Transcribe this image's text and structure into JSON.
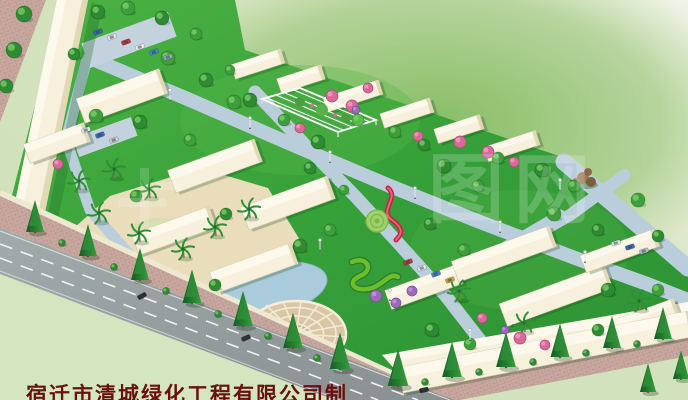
{
  "credit": {
    "text": "宿迁市清城绿化工程有限公司制"
  },
  "watermark": {
    "text": "图网"
  },
  "colors": {
    "background_top": "#f0f3e6",
    "background_field": "#86bd66",
    "lawn": "#38a03a",
    "road_main": "#97a0a0",
    "road_path": "#b9cddb",
    "sidewalk": "#c7a7a0",
    "building": "#f6f0dc",
    "plaza": "#d9c6a4",
    "water": "#aacbdb",
    "conifer": "#1d6e2c",
    "credit_red": "#6a1010",
    "watermark_white": "#ffffff"
  },
  "scene": {
    "buildings": [
      [
        258,
        64,
        52,
        15,
        -18
      ],
      [
        301,
        79,
        46,
        15,
        -18
      ],
      [
        353,
        96,
        58,
        15,
        -18
      ],
      [
        407,
        113,
        52,
        15,
        -18
      ],
      [
        459,
        129,
        48,
        15,
        -18
      ],
      [
        512,
        146,
        54,
        15,
        -18
      ],
      [
        122,
        96,
        88,
        26,
        -20
      ],
      [
        57,
        143,
        64,
        20,
        -20
      ],
      [
        215,
        166,
        92,
        24,
        -20
      ],
      [
        288,
        203,
        92,
        24,
        -20
      ],
      [
        174,
        231,
        82,
        22,
        -20
      ],
      [
        254,
        268,
        86,
        22,
        -20
      ],
      [
        424,
        287,
        76,
        20,
        -20
      ],
      [
        504,
        254,
        104,
        22,
        -20
      ],
      [
        556,
        296,
        112,
        24,
        -20
      ],
      [
        620,
        251,
        78,
        18,
        -20
      ],
      [
        646,
        317,
        64,
        16,
        -20
      ],
      [
        546,
        352,
        296,
        26,
        -11
      ]
    ],
    "conifers": [
      [
        35,
        232,
        1
      ],
      [
        88,
        256,
        1
      ],
      [
        140,
        280,
        1
      ],
      [
        192,
        303,
        1.05
      ],
      [
        243,
        326,
        1.1
      ],
      [
        293,
        348,
        1.1
      ],
      [
        340,
        369,
        1.15
      ],
      [
        398,
        386,
        1.15
      ],
      [
        452,
        377,
        1.1
      ],
      [
        506,
        367,
        1.1
      ],
      [
        560,
        357,
        1.05
      ],
      [
        612,
        348,
        1
      ],
      [
        663,
        339,
        1
      ],
      [
        648,
        392,
        0.9
      ],
      [
        681,
        379,
        0.9
      ]
    ],
    "roundTrees": [
      [
        24,
        14,
        8,
        1
      ],
      [
        14,
        50,
        8,
        1
      ],
      [
        6,
        86,
        7,
        1
      ],
      [
        98,
        12,
        7,
        1
      ],
      [
        128,
        8,
        7,
        0
      ],
      [
        162,
        18,
        7,
        1
      ],
      [
        196,
        34,
        6,
        0
      ],
      [
        74,
        54,
        6,
        1
      ],
      [
        168,
        58,
        7,
        0
      ],
      [
        206,
        80,
        7,
        1
      ],
      [
        96,
        116,
        7,
        0
      ],
      [
        140,
        122,
        7,
        1
      ],
      [
        234,
        102,
        7,
        0
      ],
      [
        250,
        100,
        7,
        1
      ],
      [
        284,
        120,
        6,
        0
      ],
      [
        318,
        142,
        7,
        1
      ],
      [
        230,
        70,
        5,
        0
      ],
      [
        358,
        120,
        6,
        2
      ],
      [
        395,
        132,
        6,
        0
      ],
      [
        424,
        145,
        6,
        1
      ],
      [
        498,
        158,
        6,
        0
      ],
      [
        542,
        170,
        7,
        1
      ],
      [
        574,
        186,
        6,
        0
      ],
      [
        190,
        140,
        6,
        0
      ],
      [
        310,
        168,
        6,
        1
      ],
      [
        344,
        190,
        5,
        0
      ],
      [
        300,
        246,
        7,
        1
      ],
      [
        330,
        230,
        6,
        0
      ],
      [
        226,
        214,
        6,
        1
      ],
      [
        136,
        196,
        6,
        0
      ],
      [
        215,
        285,
        6,
        1
      ],
      [
        444,
        166,
        7,
        1
      ],
      [
        478,
        186,
        6,
        0
      ],
      [
        430,
        224,
        6,
        1
      ],
      [
        554,
        214,
        7,
        0
      ],
      [
        598,
        230,
        6,
        1
      ],
      [
        638,
        200,
        7,
        0
      ],
      [
        658,
        236,
        6,
        1
      ],
      [
        464,
        250,
        6,
        0
      ],
      [
        608,
        290,
        7,
        1
      ],
      [
        658,
        290,
        6,
        0
      ],
      [
        432,
        330,
        7,
        1
      ],
      [
        470,
        344,
        6,
        0
      ],
      [
        598,
        330,
        6,
        1
      ],
      [
        62,
        243,
        3.5,
        1
      ],
      [
        114,
        267,
        3.5,
        1
      ],
      [
        166,
        291,
        3.5,
        1
      ],
      [
        218,
        314,
        3.5,
        1
      ],
      [
        268,
        336,
        3.5,
        1
      ],
      [
        317,
        358,
        3.5,
        1
      ],
      [
        425,
        382,
        3.5,
        1
      ],
      [
        479,
        372,
        3.5,
        1
      ],
      [
        533,
        362,
        3.5,
        1
      ],
      [
        586,
        353,
        3.5,
        1
      ],
      [
        637,
        344,
        3.5,
        1
      ]
    ],
    "palms": [
      [
        80,
        190
      ],
      [
        115,
        178
      ],
      [
        150,
        198
      ],
      [
        100,
        222
      ],
      [
        140,
        242
      ],
      [
        184,
        258
      ],
      [
        216,
        236
      ],
      [
        250,
        218
      ],
      [
        460,
        300
      ],
      [
        525,
        332
      ],
      [
        640,
        310
      ]
    ],
    "pinkShrubs": [
      [
        332,
        96,
        6
      ],
      [
        352,
        106,
        6
      ],
      [
        300,
        128,
        5
      ],
      [
        368,
        88,
        5
      ],
      [
        460,
        142,
        6
      ],
      [
        488,
        152,
        6
      ],
      [
        514,
        162,
        5
      ],
      [
        418,
        136,
        5
      ],
      [
        520,
        338,
        6
      ],
      [
        545,
        345,
        5
      ],
      [
        482,
        318,
        5
      ],
      [
        58,
        164,
        5
      ]
    ],
    "purpleShrubs": [
      [
        376,
        296,
        6
      ],
      [
        396,
        303,
        5
      ],
      [
        412,
        291,
        5
      ],
      [
        356,
        110,
        4
      ],
      [
        505,
        330,
        4
      ]
    ],
    "cars": [
      [
        98,
        32,
        -20,
        "#3a6ab8"
      ],
      [
        112,
        37,
        -20,
        "#dfe3e8"
      ],
      [
        126,
        42,
        -20,
        "#b83a3a"
      ],
      [
        140,
        47,
        -20,
        "#ececec"
      ],
      [
        154,
        52,
        -20,
        "#4a86c8"
      ],
      [
        168,
        57,
        -20,
        "#9aa8b8"
      ],
      [
        86,
        130,
        -20,
        "#dfe3e8"
      ],
      [
        100,
        135,
        -20,
        "#3a6ab8"
      ],
      [
        114,
        140,
        -20,
        "#c8cdd4"
      ],
      [
        408,
        262,
        -20,
        "#b83a3a"
      ],
      [
        422,
        268,
        -20,
        "#dfe3e8"
      ],
      [
        436,
        274,
        -20,
        "#4a86c8"
      ],
      [
        450,
        280,
        -20,
        "#caa23a"
      ],
      [
        616,
        243,
        -18,
        "#dfe3e8"
      ],
      [
        630,
        247,
        -18,
        "#3a6ab8"
      ],
      [
        644,
        251,
        -18,
        "#b8bec6"
      ],
      [
        142,
        296,
        -28,
        "#2c2c2c"
      ],
      [
        246,
        338,
        -24,
        "#303030"
      ],
      [
        424,
        390,
        -12,
        "#2a2a2a"
      ]
    ],
    "lamps": [
      [
        170,
        100
      ],
      [
        250,
        128
      ],
      [
        330,
        162
      ],
      [
        415,
        198
      ],
      [
        500,
        232
      ],
      [
        585,
        262
      ],
      [
        320,
        250
      ],
      [
        390,
        300
      ],
      [
        470,
        340
      ],
      [
        560,
        190
      ]
    ]
  }
}
